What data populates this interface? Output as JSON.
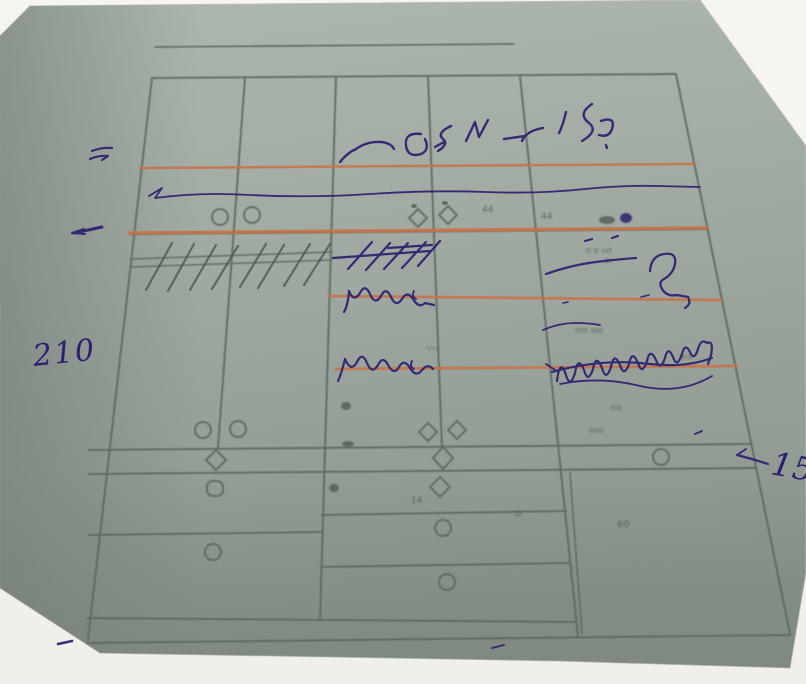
{
  "meta": {
    "scene": "photo of a hand-annotated wardrobe cutting drawing on grey-green paper",
    "colors": {
      "background": "#f2f0eb",
      "paper_top": "#aeb8af",
      "paper_bottom": "#8a948c",
      "drawing_line": "#5d675f",
      "marker_orange": "#c97348",
      "pen_ink": "#2a2070",
      "pencil": "#4f584f"
    }
  },
  "handwritten": {
    "left_dim": "210",
    "right_dim": "15",
    "hebrew_note": "המדפים",
    "hebrew_note_legible": "false"
  },
  "printed_smudges": {
    "s44a": "44",
    "s44b": "44",
    "srow1": "זווו וו וו",
    "srow2": "וב",
    "stiny": "ררר",
    "srow3": "ווווו ווזוו",
    "srow4": "בוצ",
    "srow5": "ווווו",
    "srow6": "וווווו",
    "s14": "14",
    "srow7": "וב",
    "s60": "60"
  }
}
